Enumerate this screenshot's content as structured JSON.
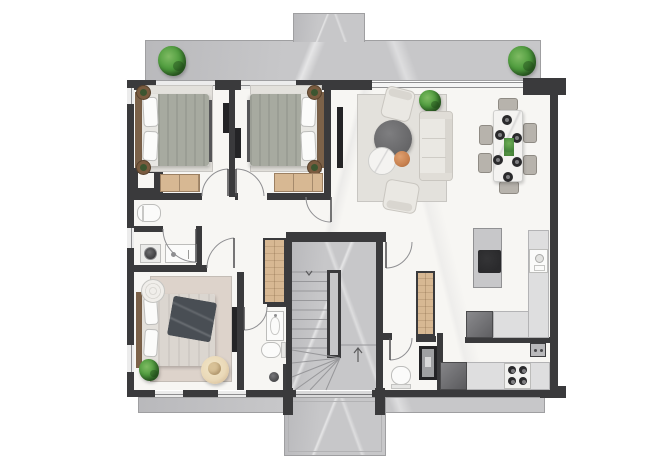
{
  "type": "architectural-floor-plan",
  "description": "Top-down 2D rendered floor plan of an apartment storey with three bedrooms, open living-dining-kitchen, two bathrooms, WC, central winder staircase, top terrace and bottom balcony. No text labels are rendered on the plan.",
  "colors": {
    "wall": "#3a3a3c",
    "floor": "#f7f6f3",
    "marble": "#c7c7c9",
    "outline": "#9f9fa1",
    "wood": "#d7b893",
    "wood_trim": "#9c8062",
    "headboard": "#7c6249",
    "duvet": "#a7aaa0",
    "duvet_warm": "#dbd6d0",
    "rug": "#e3e1dc",
    "rug_warm": "#ddd3cb",
    "sofa": "#eae8e3",
    "sofa_trim": "#c9c6c0",
    "table_dark": "#69696b",
    "marble_white": "#f4f3f1",
    "pouf": "#c8814f",
    "chair": "#b7b3ac",
    "fixture": "#fbfbfa",
    "fixture_line": "#bdbdbb",
    "plant": "#4f9c3e",
    "plant_dark": "#2f6b26",
    "appliance": "#717174",
    "appliance_dark": "#2a2a2c",
    "glass": "#d9d9da",
    "throw": "#494e54",
    "line": "#8f8f92"
  },
  "inventory": {
    "outdoor": [
      "terrace-top",
      "terrace-bump-out",
      "terrace-plant-left",
      "terrace-plant-right",
      "balcony-bottom-strip",
      "balcony-bottom-protrusion"
    ],
    "rooms": [
      "bedroom-1",
      "bedroom-2",
      "bedroom-3",
      "living-dining-room",
      "kitchen",
      "bathroom-left",
      "ensuite-bathroom",
      "wc",
      "hallway",
      "staircase"
    ],
    "living_items": [
      "sofa",
      "armchair-top",
      "armchair-bottom",
      "round-coffee-table-dark",
      "round-coffee-table-marble",
      "orange-pouf",
      "indoor-plant",
      "wall-tv",
      "dining-table",
      "dining-chairs-x6",
      "plates-x6",
      "table-centerpiece"
    ],
    "bedroom_items": [
      "double-bed-x3",
      "pillows",
      "duvet",
      "headboard",
      "nightstand-plants-x4",
      "wood-dresser-x2",
      "bedside-round-table",
      "dark-throw-blanket",
      "sun-hat",
      "bedroom-rug-x3",
      "wall-tv-bedroom-3"
    ],
    "kitchen_items": [
      "island-with-cooktop",
      "sink-counter",
      "corner-counter",
      "built-in-oven",
      "dishwasher",
      "gas-hob-4-burner",
      "socket-panel"
    ],
    "bath_items": [
      "round-washbasin-on-stand",
      "vanity-unit",
      "niche-toilet",
      "washbasin-ensuite",
      "toilet-ensuite",
      "shower-drain",
      "glass-screen",
      "wc-toilet",
      "shower-column"
    ],
    "circulation": [
      "winder-staircase",
      "stair-stringer",
      "direction-arrow-up",
      "door-swing-arcs-x8",
      "wardrobe-column-x2"
    ]
  }
}
